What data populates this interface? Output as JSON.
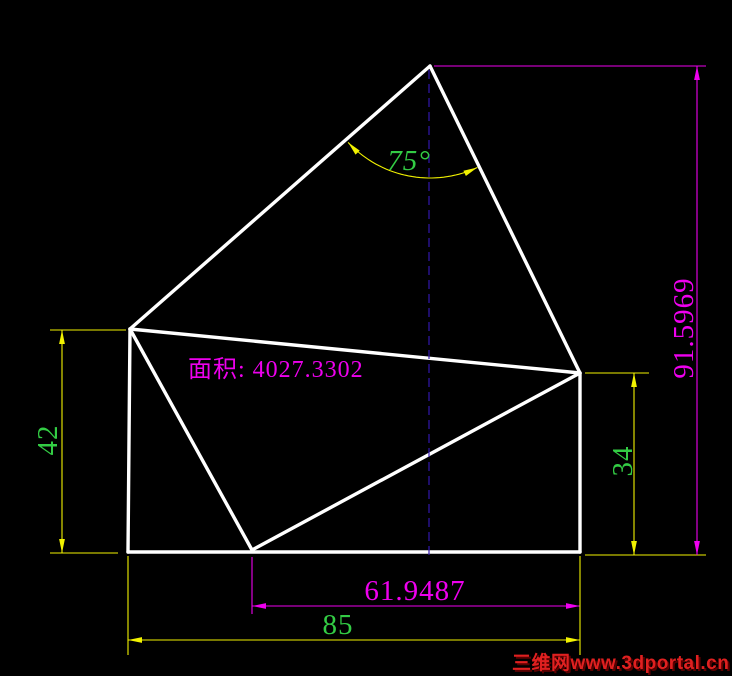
{
  "canvas": {
    "width": 732,
    "height": 676,
    "background": "#000000"
  },
  "colors": {
    "shape": "#FFFFFF",
    "yellow": "#F2F200",
    "magenta": "#EE00EE",
    "green": "#33CC44",
    "centerline": "#3318AE",
    "watermark": "#E02020",
    "watermark_shadow": "#5A0000"
  },
  "drawing": {
    "vertices": {
      "apex": {
        "x": 430,
        "y": 66
      },
      "left": {
        "x": 130,
        "y": 329
      },
      "right": {
        "x": 580,
        "y": 373
      },
      "bottom_left": {
        "x": 128,
        "y": 552
      },
      "bottom_mid": {
        "x": 252,
        "y": 550
      },
      "bottom_right": {
        "x": 580,
        "y": 552
      }
    },
    "edges": [
      [
        "apex",
        "left"
      ],
      [
        "apex",
        "right"
      ],
      [
        "left",
        "bottom_left"
      ],
      [
        "bottom_left",
        "bottom_right"
      ],
      [
        "right",
        "bottom_right"
      ],
      [
        "left",
        "right"
      ],
      [
        "left",
        "bottom_mid"
      ],
      [
        "bottom_mid",
        "right"
      ]
    ],
    "centerline": {
      "x": 429,
      "y1": 70,
      "y2": 558
    }
  },
  "dimensions": {
    "angle": {
      "label": "75°",
      "value": 75,
      "center": {
        "x": 430,
        "y": 66
      },
      "radius": 112,
      "start_deg": 65,
      "end_deg": 137,
      "text": {
        "x": 409,
        "y": 170,
        "size": 29,
        "anchor": "middle"
      }
    },
    "linear": [
      {
        "label": "42",
        "value": 42,
        "color": "yellow",
        "label_color": "green",
        "axis": "vertical",
        "pos": 62,
        "from": 330,
        "to": 553,
        "ext": [
          [
            50,
            330,
            126,
            330
          ],
          [
            50,
            553,
            118,
            553
          ]
        ],
        "text": {
          "x": 57,
          "y": 440,
          "size": 29,
          "rotate": -90,
          "anchor": "middle"
        }
      },
      {
        "label": "34",
        "value": 34,
        "color": "yellow",
        "label_color": "green",
        "axis": "vertical",
        "pos": 634,
        "from": 373,
        "to": 555,
        "ext": [
          [
            585,
            373,
            649,
            373
          ],
          [
            585,
            555,
            706,
            555
          ]
        ],
        "text": {
          "x": 632,
          "y": 461,
          "size": 29,
          "rotate": -90,
          "anchor": "middle"
        }
      },
      {
        "label": "61.9487",
        "value": 61.9487,
        "color": "magenta",
        "label_color": "magenta",
        "axis": "horizontal",
        "pos": 606,
        "from": 252,
        "to": 580,
        "ext": [
          [
            252,
            557,
            252,
            614
          ]
        ],
        "text": {
          "x": 415,
          "y": 600,
          "size": 29,
          "anchor": "middle"
        }
      },
      {
        "label": "85",
        "value": 85,
        "color": "yellow",
        "label_color": "green",
        "axis": "horizontal",
        "pos": 640,
        "from": 128,
        "to": 580,
        "ext": [
          [
            128,
            556,
            128,
            655
          ],
          [
            580,
            556,
            580,
            655
          ]
        ],
        "text": {
          "x": 338,
          "y": 634,
          "size": 29,
          "anchor": "middle"
        }
      },
      {
        "label": "91.5969",
        "value": 91.5969,
        "color": "magenta",
        "label_color": "magenta",
        "axis": "vertical",
        "pos": 697,
        "from": 66,
        "to": 555,
        "ext": [
          [
            434,
            66,
            706,
            66
          ]
        ],
        "text": {
          "x": 693,
          "y": 328,
          "size": 29,
          "rotate": -90,
          "anchor": "middle"
        }
      }
    ]
  },
  "annotations": {
    "area_label": {
      "text": "面积: 4027.3302",
      "x": 188,
      "y": 377,
      "size": 24,
      "anchor": "start"
    }
  },
  "watermark": {
    "text": "三维网www.3dportal.cn",
    "x": 512,
    "y": 669,
    "size": 19,
    "anchor": "start"
  }
}
